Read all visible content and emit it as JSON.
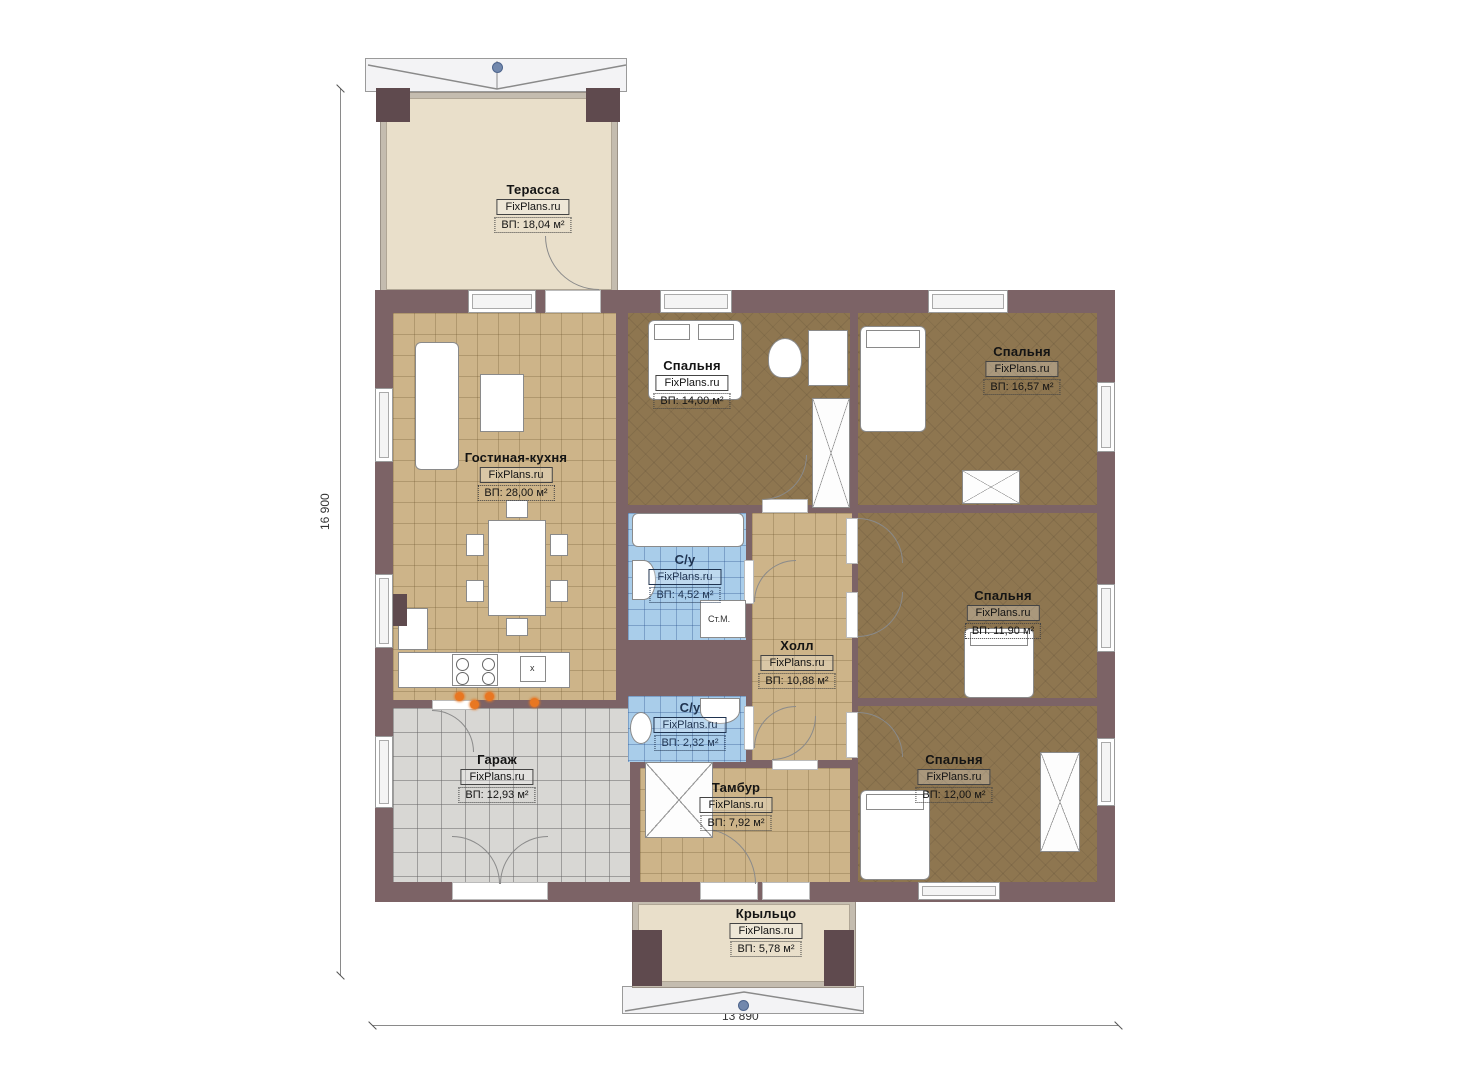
{
  "meta": {
    "brand": "FixPlans.ru"
  },
  "dimensions": {
    "height_label": "16 900",
    "width_label": "13 890"
  },
  "rooms": {
    "terrace": {
      "name": "Терасса",
      "brand": "FixPlans.ru",
      "area": "ВП: 18,04 м²"
    },
    "living": {
      "name": "Гостиная-кухня",
      "brand": "FixPlans.ru",
      "area": "ВП: 28,00 м²"
    },
    "bedroom1": {
      "name": "Спальня",
      "brand": "FixPlans.ru",
      "area": "ВП: 14,00 м²"
    },
    "bedroom2": {
      "name": "Спальня",
      "brand": "FixPlans.ru",
      "area": "ВП: 16,57 м²"
    },
    "bathroom1": {
      "name": "С/у",
      "brand": "FixPlans.ru",
      "area": "ВП: 4,52 м²"
    },
    "hall": {
      "name": "Холл",
      "brand": "FixPlans.ru",
      "area": "ВП: 10,88 м²"
    },
    "bedroom3": {
      "name": "Спальня",
      "brand": "FixPlans.ru",
      "area": "ВП: 11,90 м²"
    },
    "bathroom2": {
      "name": "С/у",
      "brand": "FixPlans.ru",
      "area": "ВП: 2,32 м²"
    },
    "garage": {
      "name": "Гараж",
      "brand": "FixPlans.ru",
      "area": "ВП: 12,93 м²"
    },
    "tambour": {
      "name": "Тамбур",
      "brand": "FixPlans.ru",
      "area": "ВП: 7,92 м²"
    },
    "bedroom4": {
      "name": "Спальня",
      "brand": "FixPlans.ru",
      "area": "ВП: 12,00 м²"
    },
    "porch": {
      "name": "Крыльцо",
      "brand": "FixPlans.ru",
      "area": "ВП: 5,78 м²"
    }
  },
  "annotations": {
    "washing_machine": "Ст.М.",
    "sink": "x"
  },
  "colors": {
    "wall": "#7c6366",
    "floor_tile": "#cdb489",
    "floor_bedroom": "#8e7650",
    "floor_bath": "#a9cdea",
    "floor_garage": "#d8d7d4",
    "floor_terrace": "#e9dfca",
    "burner_accent": "#e87722",
    "ridge_marker": "#7288ad"
  }
}
